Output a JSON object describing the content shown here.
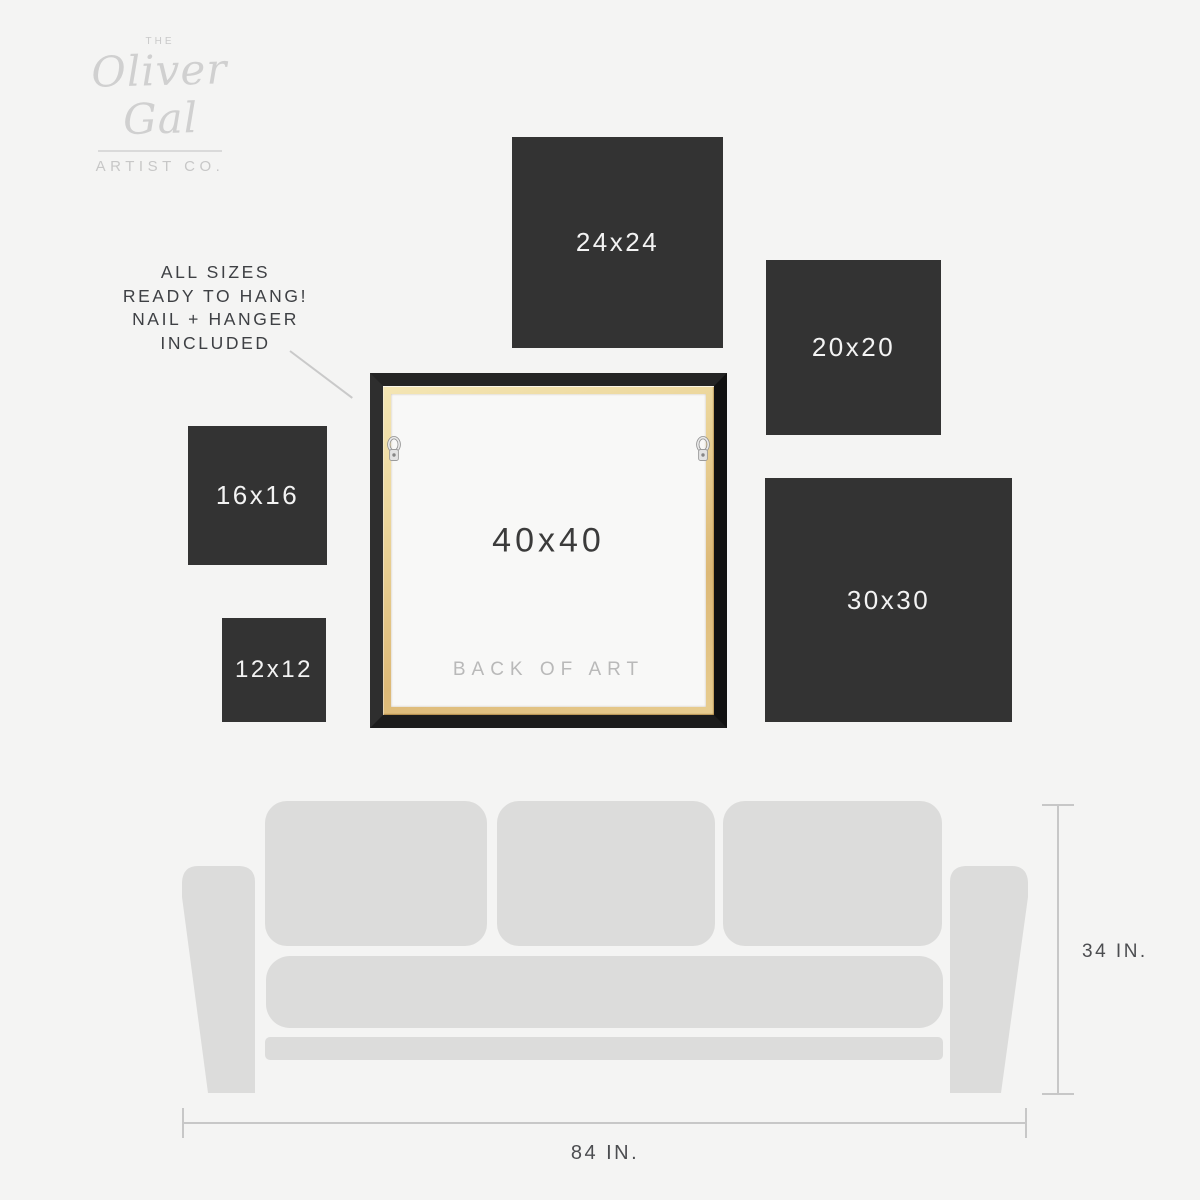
{
  "brand": {
    "the": "THE",
    "name": "Oliver Gal",
    "subtitle": "ARTIST CO."
  },
  "note": {
    "lines": [
      "ALL SIZES",
      "READY TO HANG!",
      "NAIL + HANGER",
      "INCLUDED"
    ]
  },
  "squares": [
    {
      "label": "24x24"
    },
    {
      "label": "20x20"
    },
    {
      "label": "16x16"
    },
    {
      "label": "12x12"
    },
    {
      "label": "30x30"
    }
  ],
  "frame": {
    "label": "40x40",
    "back_label": "BACK OF ART"
  },
  "sofa": {
    "height_label": "34 IN.",
    "width_label": "84 IN."
  },
  "colors": {
    "background": "#f4f4f3",
    "square": "#333333",
    "square_text": "#f3f3f3",
    "sofa": "#dcdcdb",
    "frame_black": "#1a1a1a",
    "wood": "#dfbe7e",
    "canvas_back": "#f8f8f7",
    "dimension_line": "#c7c7c7",
    "note_text": "#3e4044",
    "logo_gray": "#d0d0d0"
  }
}
